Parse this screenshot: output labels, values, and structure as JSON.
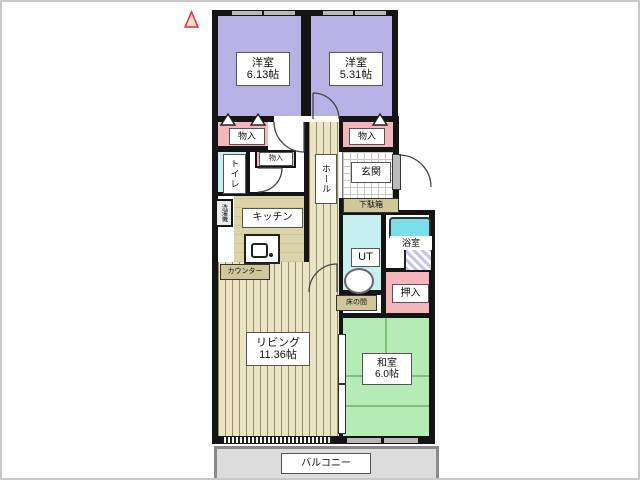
{
  "plan": {
    "labels": {
      "bedroom1_name": "洋室",
      "bedroom1_size": "6.13帖",
      "bedroom2_name": "洋室",
      "bedroom2_size": "5.31帖",
      "living_name": "リビング",
      "living_size": "11.36帖",
      "washitsu_name": "和室",
      "washitsu_size": "6.0帖",
      "kitchen": "キッチン",
      "counter": "カウンター",
      "laundry": "洗濯機",
      "toilet": "トイレ",
      "hall": "ホール",
      "genkan": "玄関",
      "getabako": "下駄箱",
      "ut": "UT",
      "bath": "浴室",
      "oshiire": "押入",
      "tokonoma": "床の間",
      "monoire_left": "物入",
      "monoire_small": "物入",
      "monoire_right": "物入",
      "balcony": "バルコニー"
    },
    "colors": {
      "western_room": "#b7b1e6",
      "closet_pink": "#f4b6bc",
      "wet_area_cyan": "#c6eff2",
      "kitchen_khaki": "#d8d1a6",
      "tatami_green": "#b5ecb5",
      "bathtub": "#7adfe8",
      "flooring_stripe": "#eae4c4",
      "balcony_gray": "#dcdcdc",
      "wall": "#141414",
      "north_mark_red": "#e03030"
    }
  }
}
